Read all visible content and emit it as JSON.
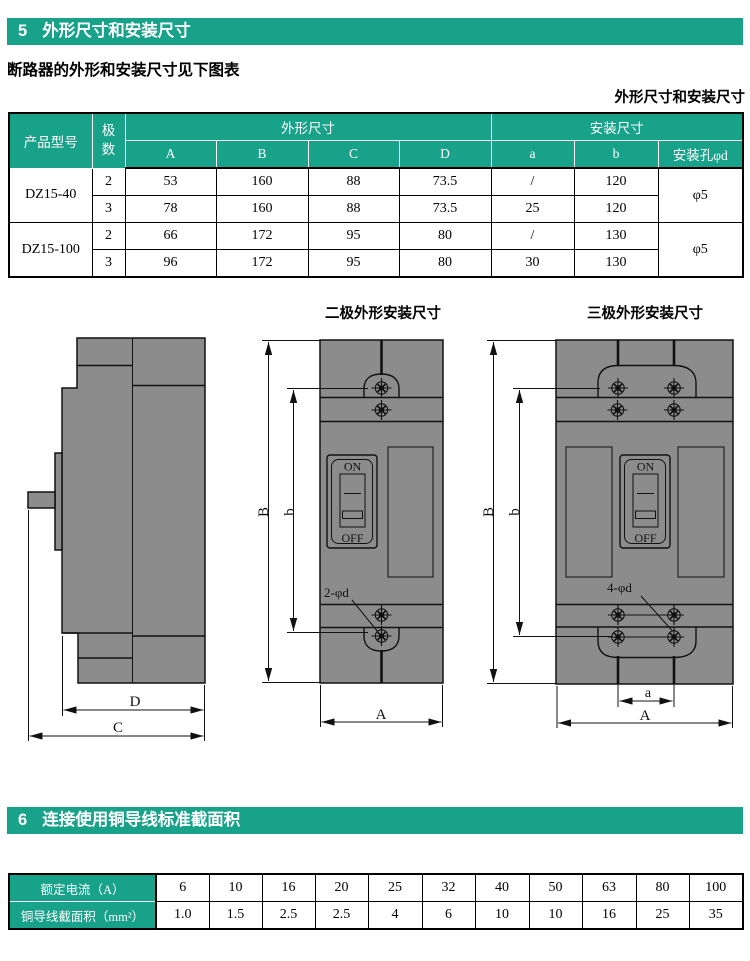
{
  "colors": {
    "accent": "#19A28A",
    "drawing_gray": "#8C8C8C"
  },
  "section5": {
    "number": "5",
    "title": "外形尺寸和安装尺寸"
  },
  "intro_text": "断路器的外形和安装尺寸见下图表",
  "table_caption": "外形尺寸和安装尺寸",
  "dim_table": {
    "header": {
      "product": "产品型号",
      "poles": "极数",
      "outline": "外形尺寸",
      "mounting": "安装尺寸",
      "hole": "安装孔φd",
      "cols": [
        "A",
        "B",
        "C",
        "D",
        "a",
        "b"
      ]
    },
    "groups": [
      {
        "model": "DZ15-40",
        "hole": "φ5",
        "rows": [
          [
            "2",
            "53",
            "160",
            "88",
            "73.5",
            "/",
            "120"
          ],
          [
            "3",
            "78",
            "160",
            "88",
            "73.5",
            "25",
            "120"
          ]
        ]
      },
      {
        "model": "DZ15-100",
        "hole": "φ5",
        "rows": [
          [
            "2",
            "66",
            "172",
            "95",
            "80",
            "/",
            "130"
          ],
          [
            "3",
            "96",
            "172",
            "95",
            "80",
            "30",
            "130"
          ]
        ]
      }
    ]
  },
  "drawings": {
    "side": {
      "dim_d": "D",
      "dim_c": "C"
    },
    "two_pole": {
      "title": "二极外形安装尺寸",
      "dim_B": "B",
      "dim_b": "b",
      "dim_A": "A",
      "hole_label": "2-φd",
      "switch_on": "ON",
      "switch_off": "OFF"
    },
    "three_pole": {
      "title": "三极外形安装尺寸",
      "dim_B": "B",
      "dim_b": "b",
      "dim_A": "A",
      "dim_a": "a",
      "hole_label": "4-φd",
      "switch_on": "ON",
      "switch_off": "OFF"
    }
  },
  "section6": {
    "number": "6",
    "title": "连接使用铜导线标准截面积"
  },
  "wire_table": {
    "row1_label": "额定电流（A）",
    "row2_label": "铜导线截面积（mm²）",
    "currents": [
      "6",
      "10",
      "16",
      "20",
      "25",
      "32",
      "40",
      "50",
      "63",
      "80",
      "100"
    ],
    "areas": [
      "1.0",
      "1.5",
      "2.5",
      "2.5",
      "4",
      "6",
      "10",
      "10",
      "16",
      "25",
      "35"
    ]
  }
}
